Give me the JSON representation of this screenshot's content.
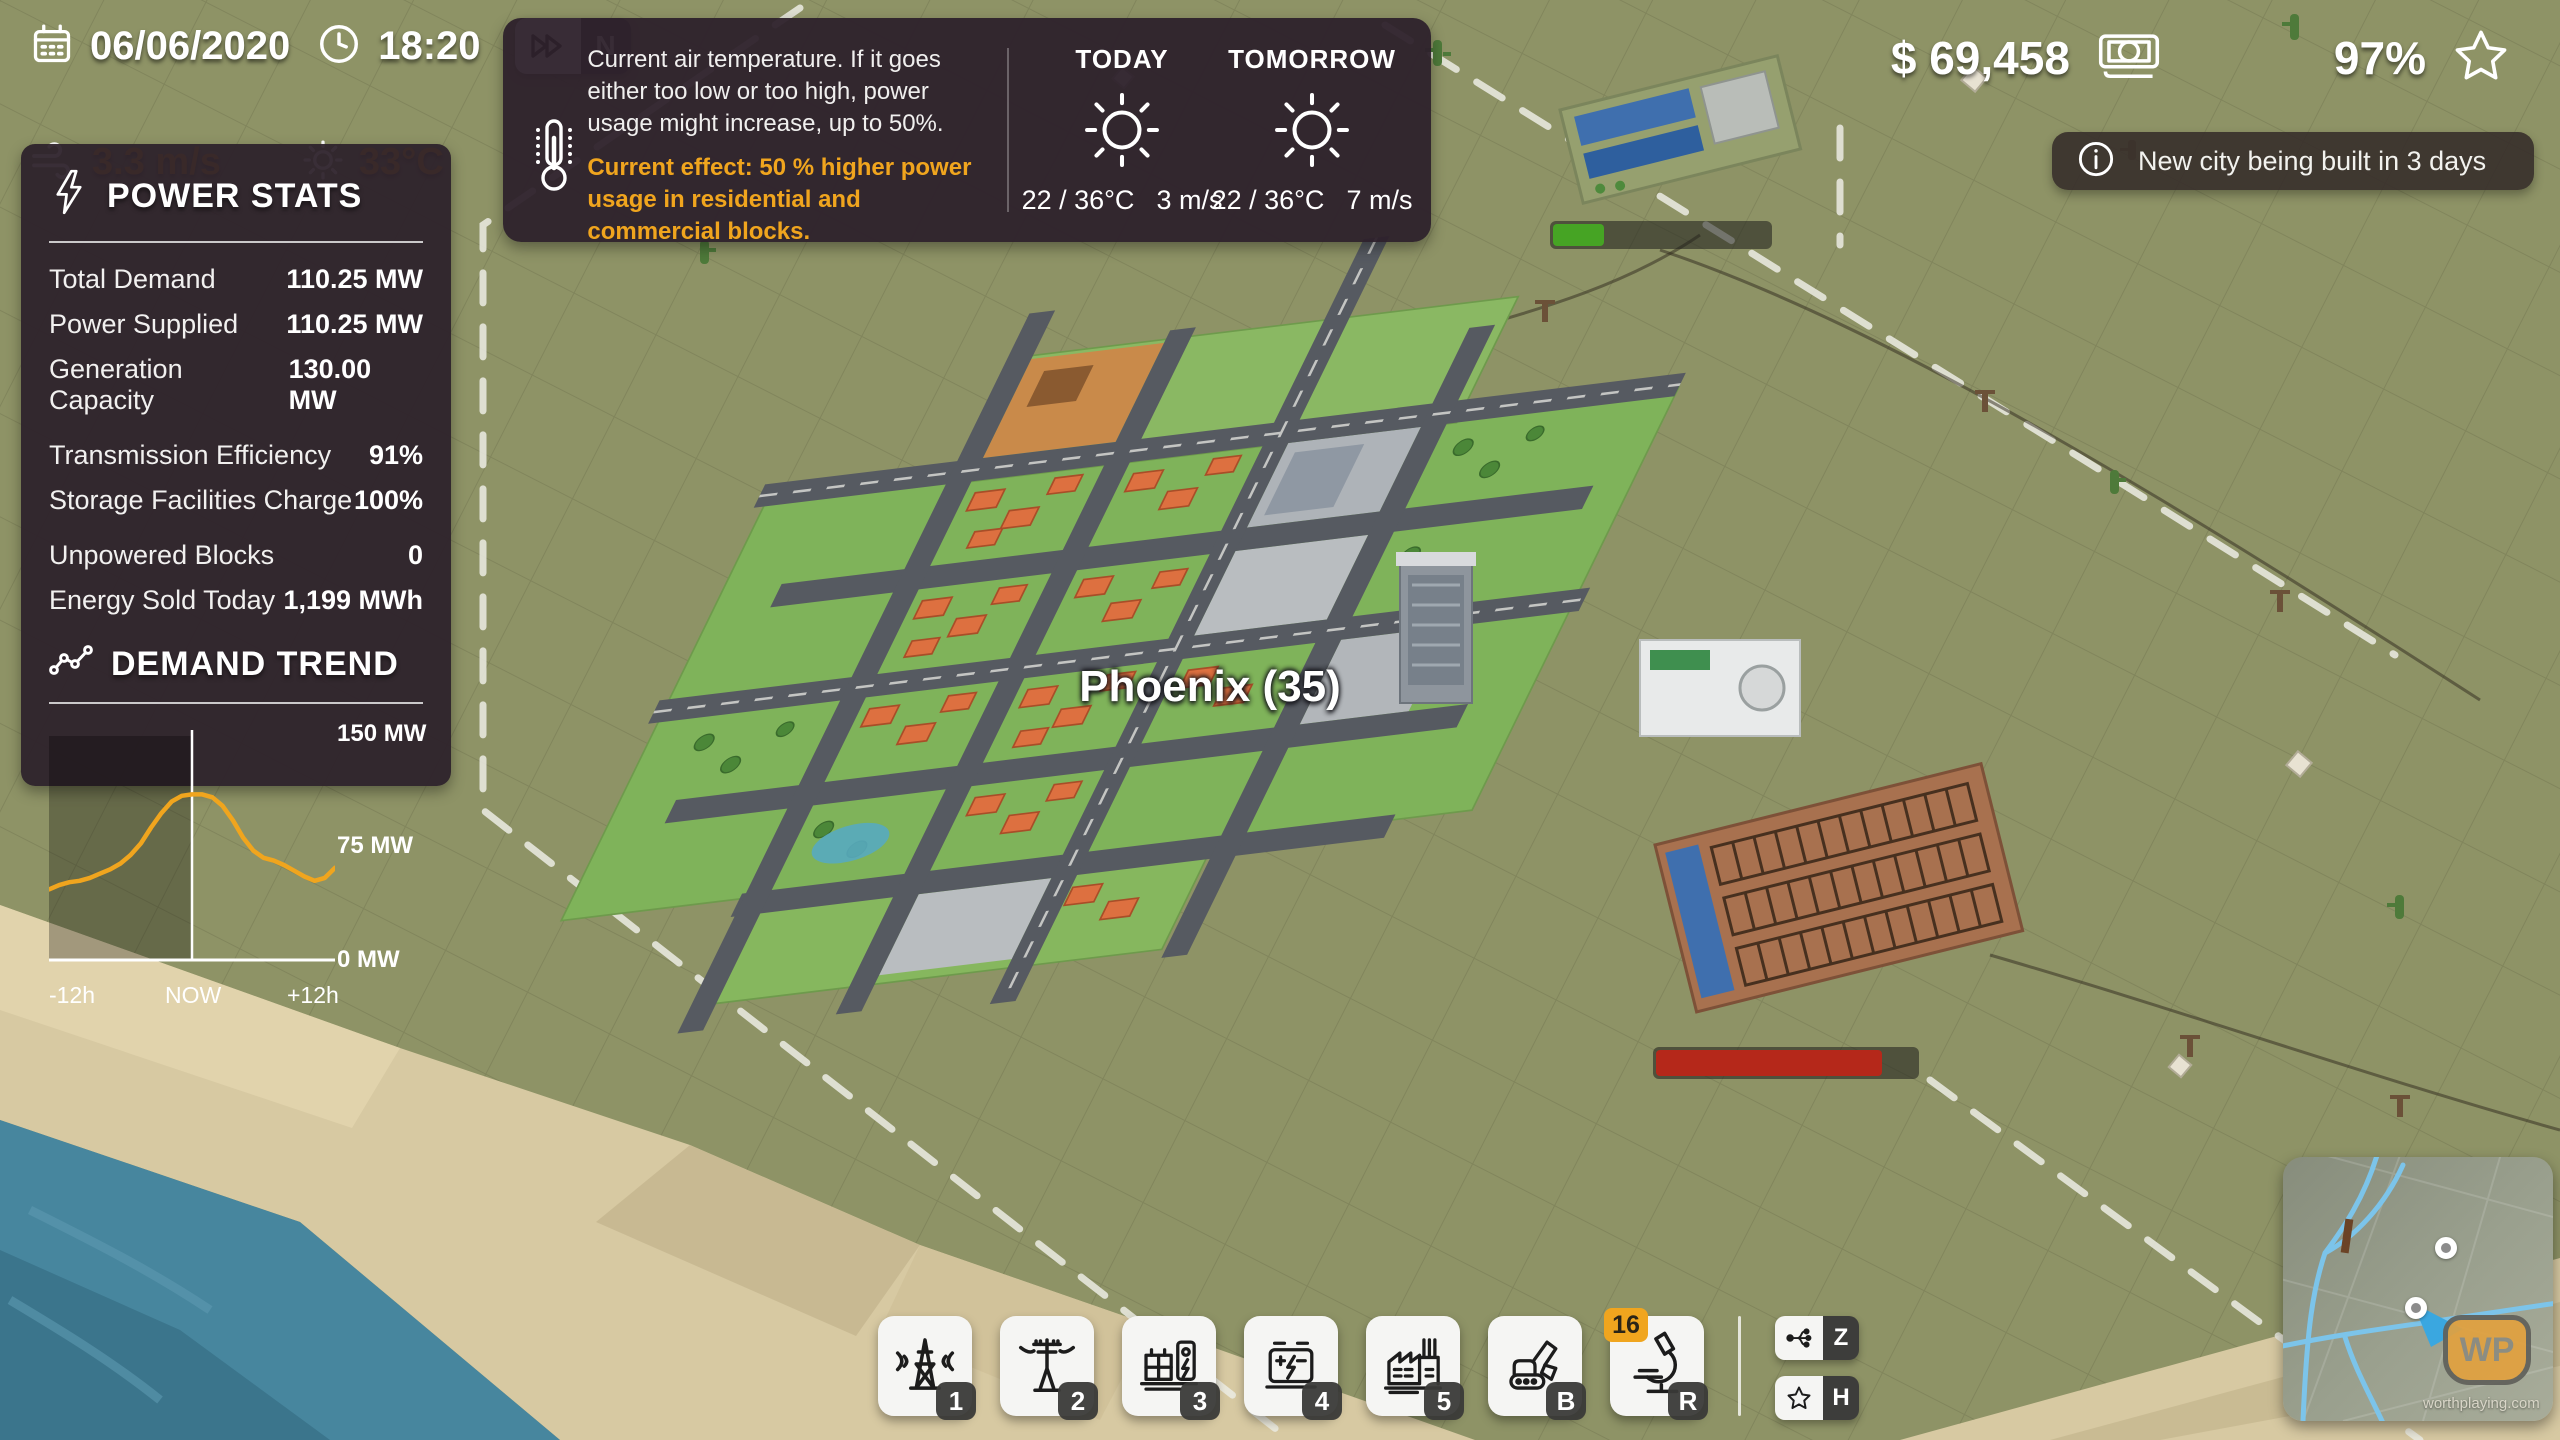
{
  "hud": {
    "date": "06/06/2020",
    "time": "18:20",
    "speed_mode": "N",
    "wind_speed": "3.3 m/s",
    "temperature": "33°C",
    "money": "$ 69,458",
    "satisfaction": "97%"
  },
  "weather_panel": {
    "description": "Current air temperature. If it goes either too low or too high, power usage might increase, up to 50%.",
    "effect": "Current effect: 50 % higher power usage in residential and commercial blocks.",
    "forecast": [
      {
        "label": "TODAY",
        "temps": "22 / 36°C",
        "wind": "3 m/s"
      },
      {
        "label": "TOMORROW",
        "temps": "22 / 36°C",
        "wind": "7 m/s"
      }
    ]
  },
  "notification": {
    "text": "New city being built in 3 days"
  },
  "power_stats": {
    "title": "POWER STATS",
    "rows": [
      {
        "label": "Total Demand",
        "value": "110.25 MW"
      },
      {
        "label": "Power Supplied",
        "value": "110.25 MW"
      },
      {
        "label": "Generation Capacity",
        "value": "130.00 MW"
      },
      {
        "label": "Transmission Efficiency",
        "value": "91%"
      },
      {
        "label": "Storage Facilities Charge",
        "value": "100%"
      },
      {
        "label": "Unpowered Blocks",
        "value": "0"
      },
      {
        "label": "Energy Sold Today",
        "value": "1,199 MWh"
      }
    ]
  },
  "chart_data": {
    "type": "line",
    "title": "DEMAND TREND",
    "xlabel": "",
    "ylabel": "MW",
    "ylim": [
      0,
      150
    ],
    "x_range_hours": [
      -12,
      12
    ],
    "x_tick_labels": [
      "-12h",
      "NOW",
      "+12h"
    ],
    "y_tick_labels": [
      "150 MW",
      "75 MW",
      "0 MW"
    ],
    "now_fraction": 0.5,
    "series_color": "#f0a51e",
    "values": [
      49,
      52,
      54,
      55,
      57,
      60,
      63,
      67,
      73,
      81,
      92,
      102,
      110,
      114,
      115,
      115,
      113,
      107,
      97,
      85,
      76,
      71,
      69,
      66,
      62,
      58,
      55,
      57,
      64
    ]
  },
  "map": {
    "city_label": "Phoenix (35)",
    "north_city_progress_percent": 23,
    "north_city_progress_color": "#46a424",
    "substation_bar_percent": 85,
    "substation_bar_color": "#b5281a"
  },
  "toolbar": {
    "buttons": [
      {
        "icon": "transmission-tower-icon",
        "badge": "1"
      },
      {
        "icon": "power-pole-icon",
        "badge": "2"
      },
      {
        "icon": "substation-icon",
        "badge": "3"
      },
      {
        "icon": "battery-icon",
        "badge": "4"
      },
      {
        "icon": "factory-icon",
        "badge": "5"
      },
      {
        "icon": "excavator-icon",
        "badge": "B"
      },
      {
        "icon": "microscope-icon",
        "badge": "R",
        "count": "16"
      }
    ],
    "shortcuts": [
      {
        "icon": "network-icon",
        "key": "Z"
      },
      {
        "icon": "star-icon",
        "key": "H"
      }
    ]
  },
  "minimap": {
    "watermark_logo": "WP",
    "watermark_text": "worthplaying.com"
  },
  "colors": {
    "accent": "#f0a51e",
    "panel": "#2d212b",
    "terrain": "#8e9366",
    "water": "#47869e",
    "sand": "#d7c9a2"
  }
}
